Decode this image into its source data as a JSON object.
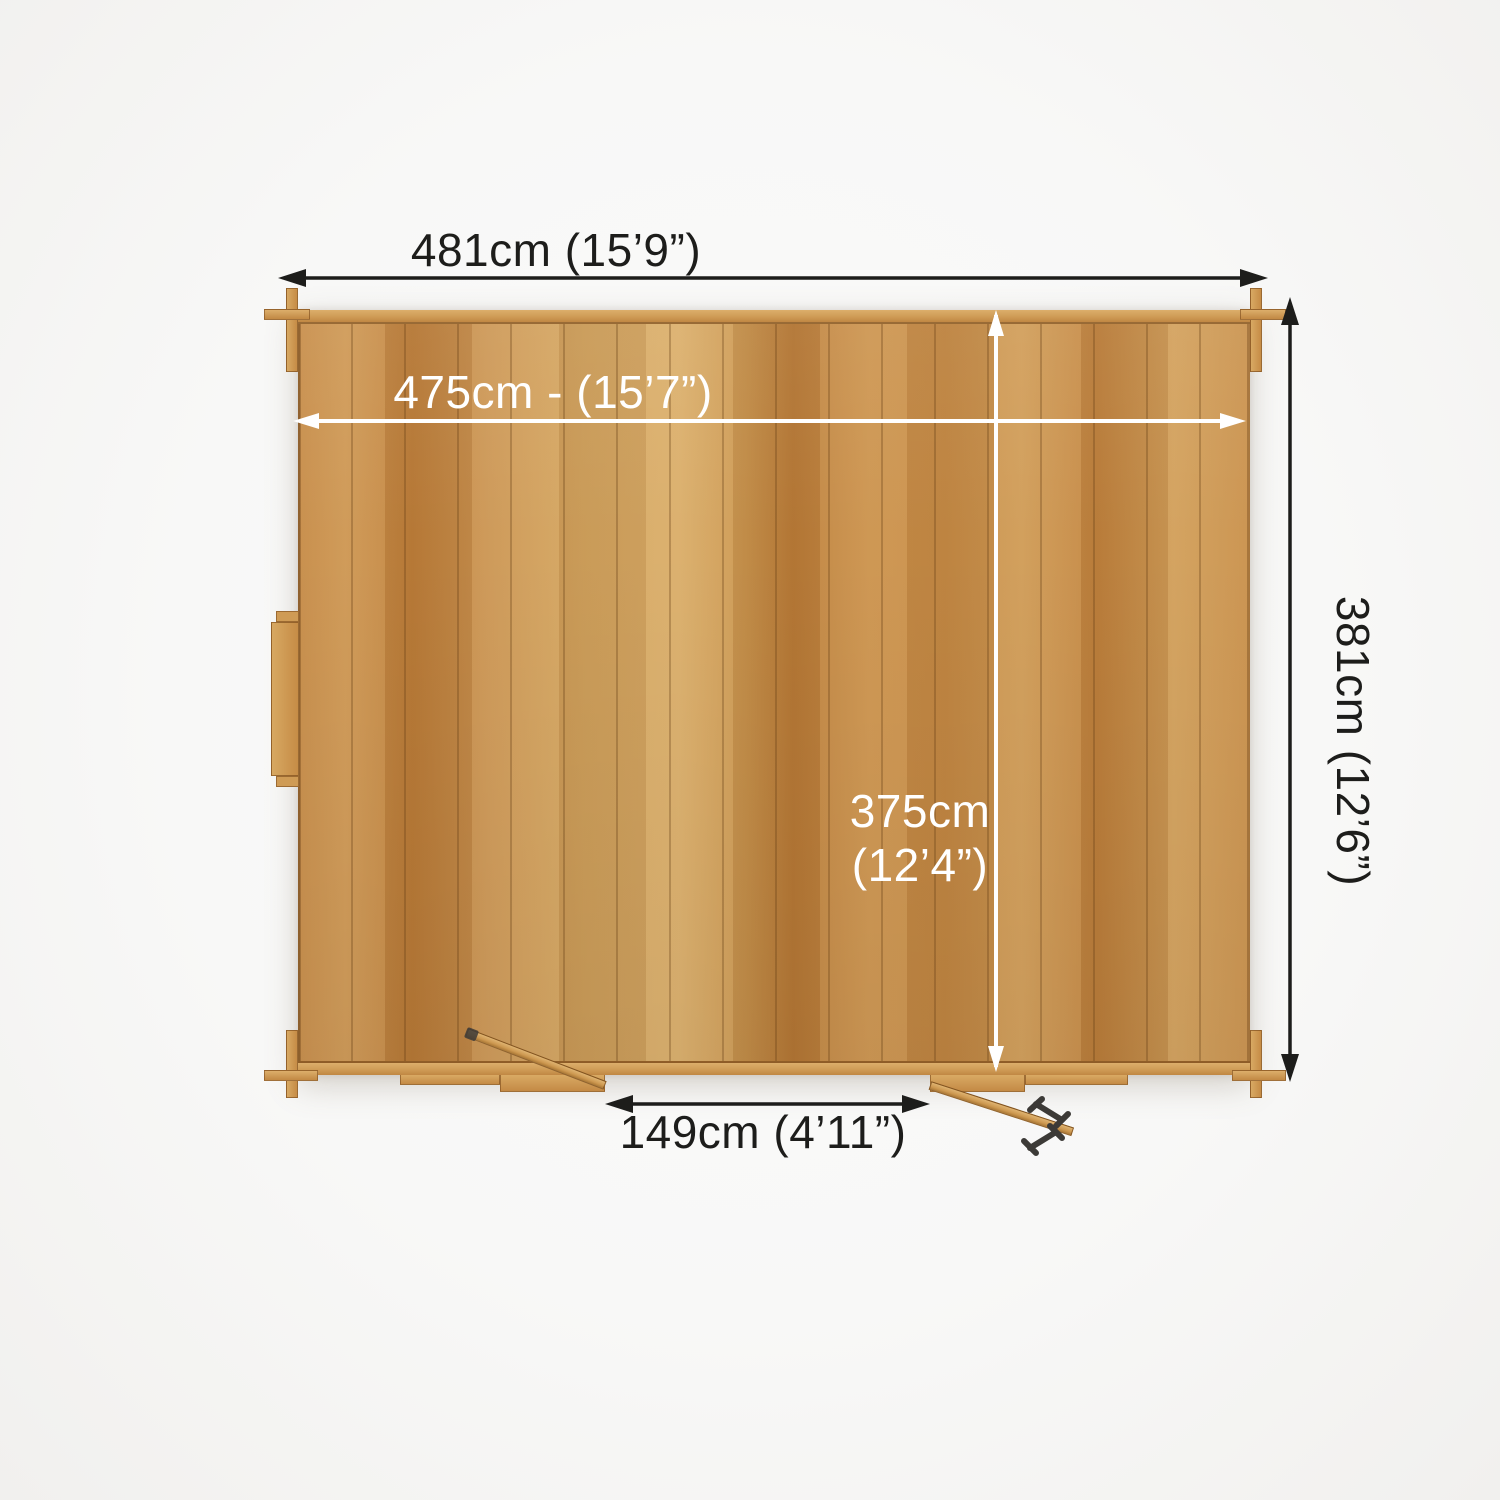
{
  "diagram": {
    "title": "Log cabin top-down floor plan with dimensions",
    "labels": {
      "outer_width": "481cm (15’9”)",
      "inner_width": "475cm - (15’7”)",
      "outer_depth": "381cm (12’6”)",
      "inner_depth_line1": "375cm",
      "inner_depth_line2": "(12’4”)",
      "door_width": "149cm (4’11”)"
    }
  },
  "colors": {
    "ink": "#1d1d1b",
    "dimension-white": "#ffffff",
    "wood-light": "#d8ab68",
    "wood-mid": "#c9934e",
    "wood-dark": "#b97b38",
    "wood-seam": "#8a5c24",
    "hardware": "#3c3a37",
    "background": "#fafafa"
  }
}
